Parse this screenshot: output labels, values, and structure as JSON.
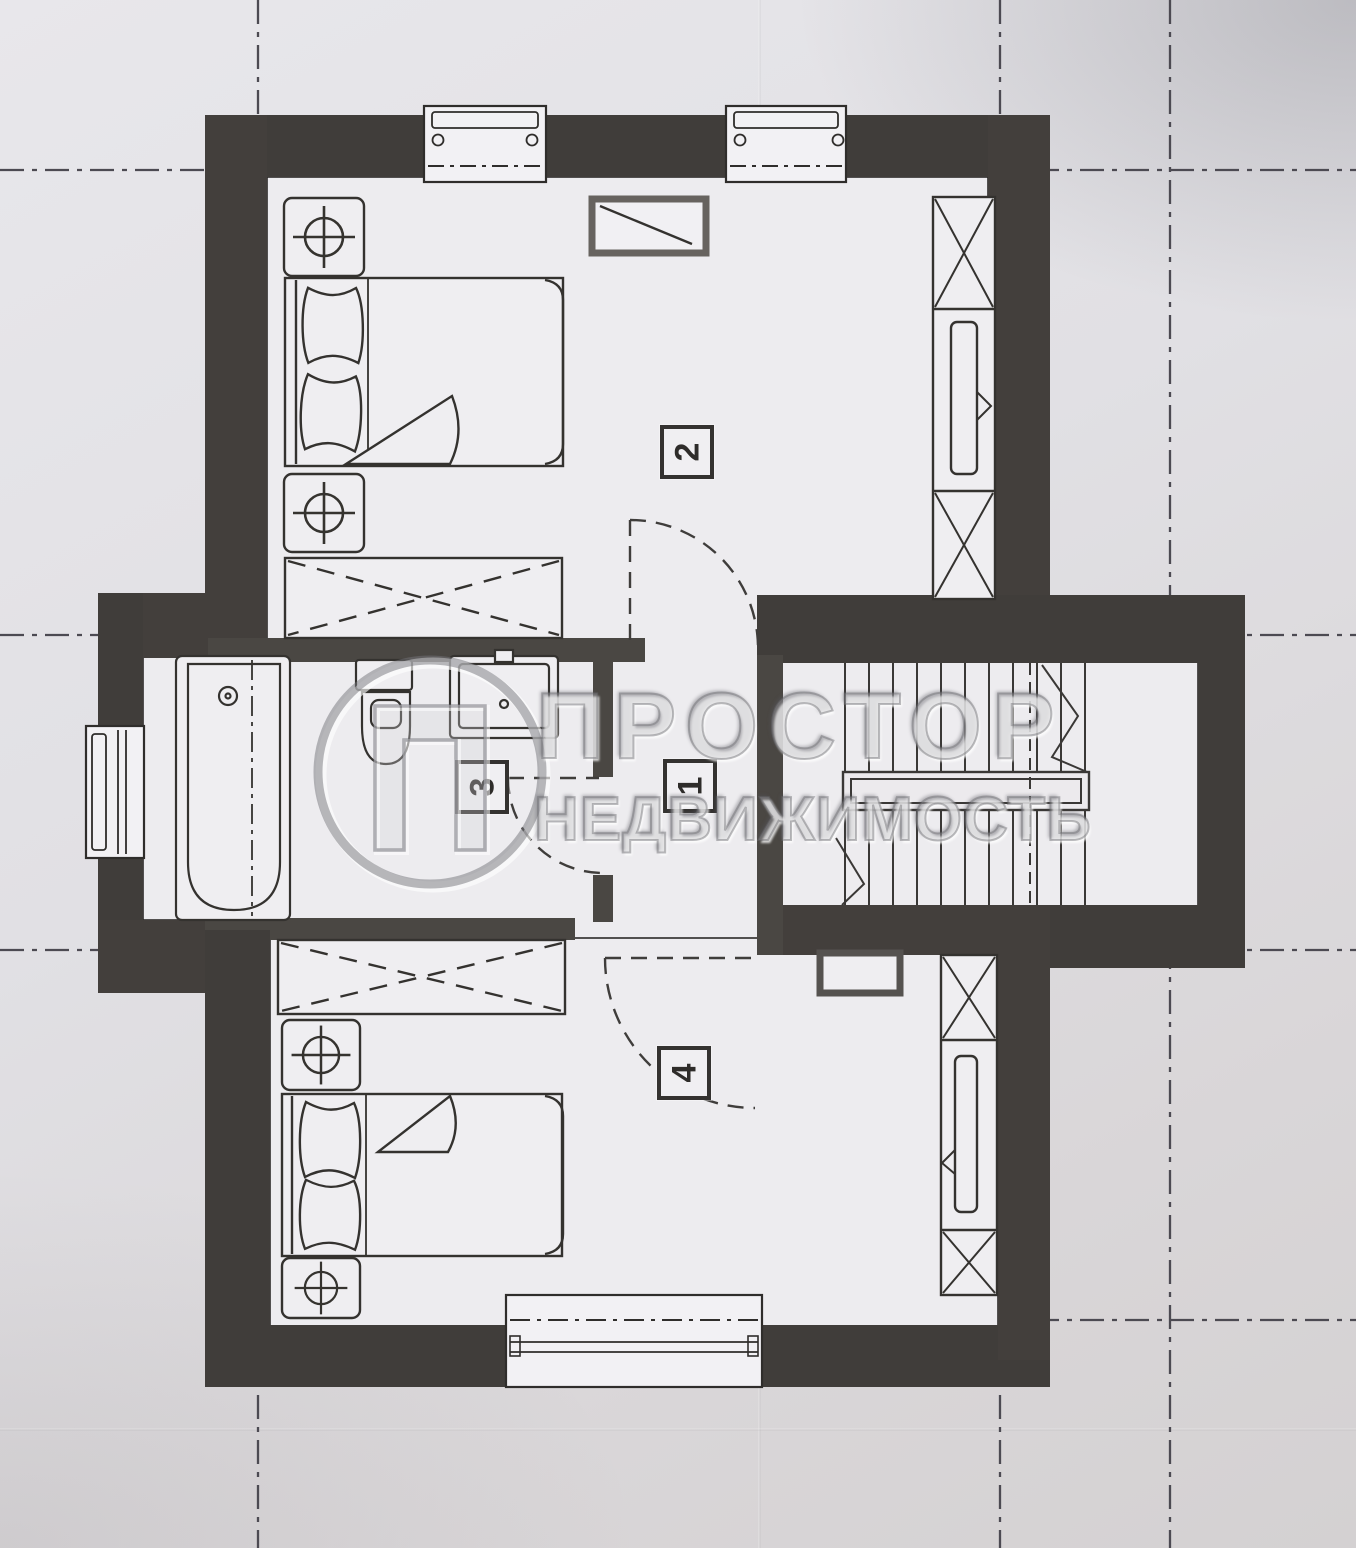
{
  "document": {
    "kind": "scanned-floor-plan"
  },
  "watermark": {
    "brand_line1": "ПРОСТОР",
    "brand_line2": "НЕДВИЖИМОСТЬ",
    "logo": "prostor-circle-p-logo"
  },
  "rooms": [
    {
      "number": "1"
    },
    {
      "number": "2"
    },
    {
      "number": "3"
    },
    {
      "number": "4"
    }
  ],
  "symbols": [
    "double-bed",
    "pillow",
    "blanket-fold",
    "nightstand-crosshair-lamp",
    "wardrobe-dashed-x",
    "tall-wardrobe-rail",
    "bathtub",
    "toilet",
    "washbasin",
    "staircase-u-turn",
    "stair-handrail",
    "door-swing-arc",
    "window-with-hinges",
    "vent-niche",
    "axis-line-dash-dot",
    "watermark-logo"
  ],
  "colors": {
    "wall": "#46423e",
    "paper": "#e0dfe3",
    "floor": "#edecef",
    "line": "#35332f",
    "axis": "#4c4a52",
    "watermark": "#a8a8ac"
  }
}
